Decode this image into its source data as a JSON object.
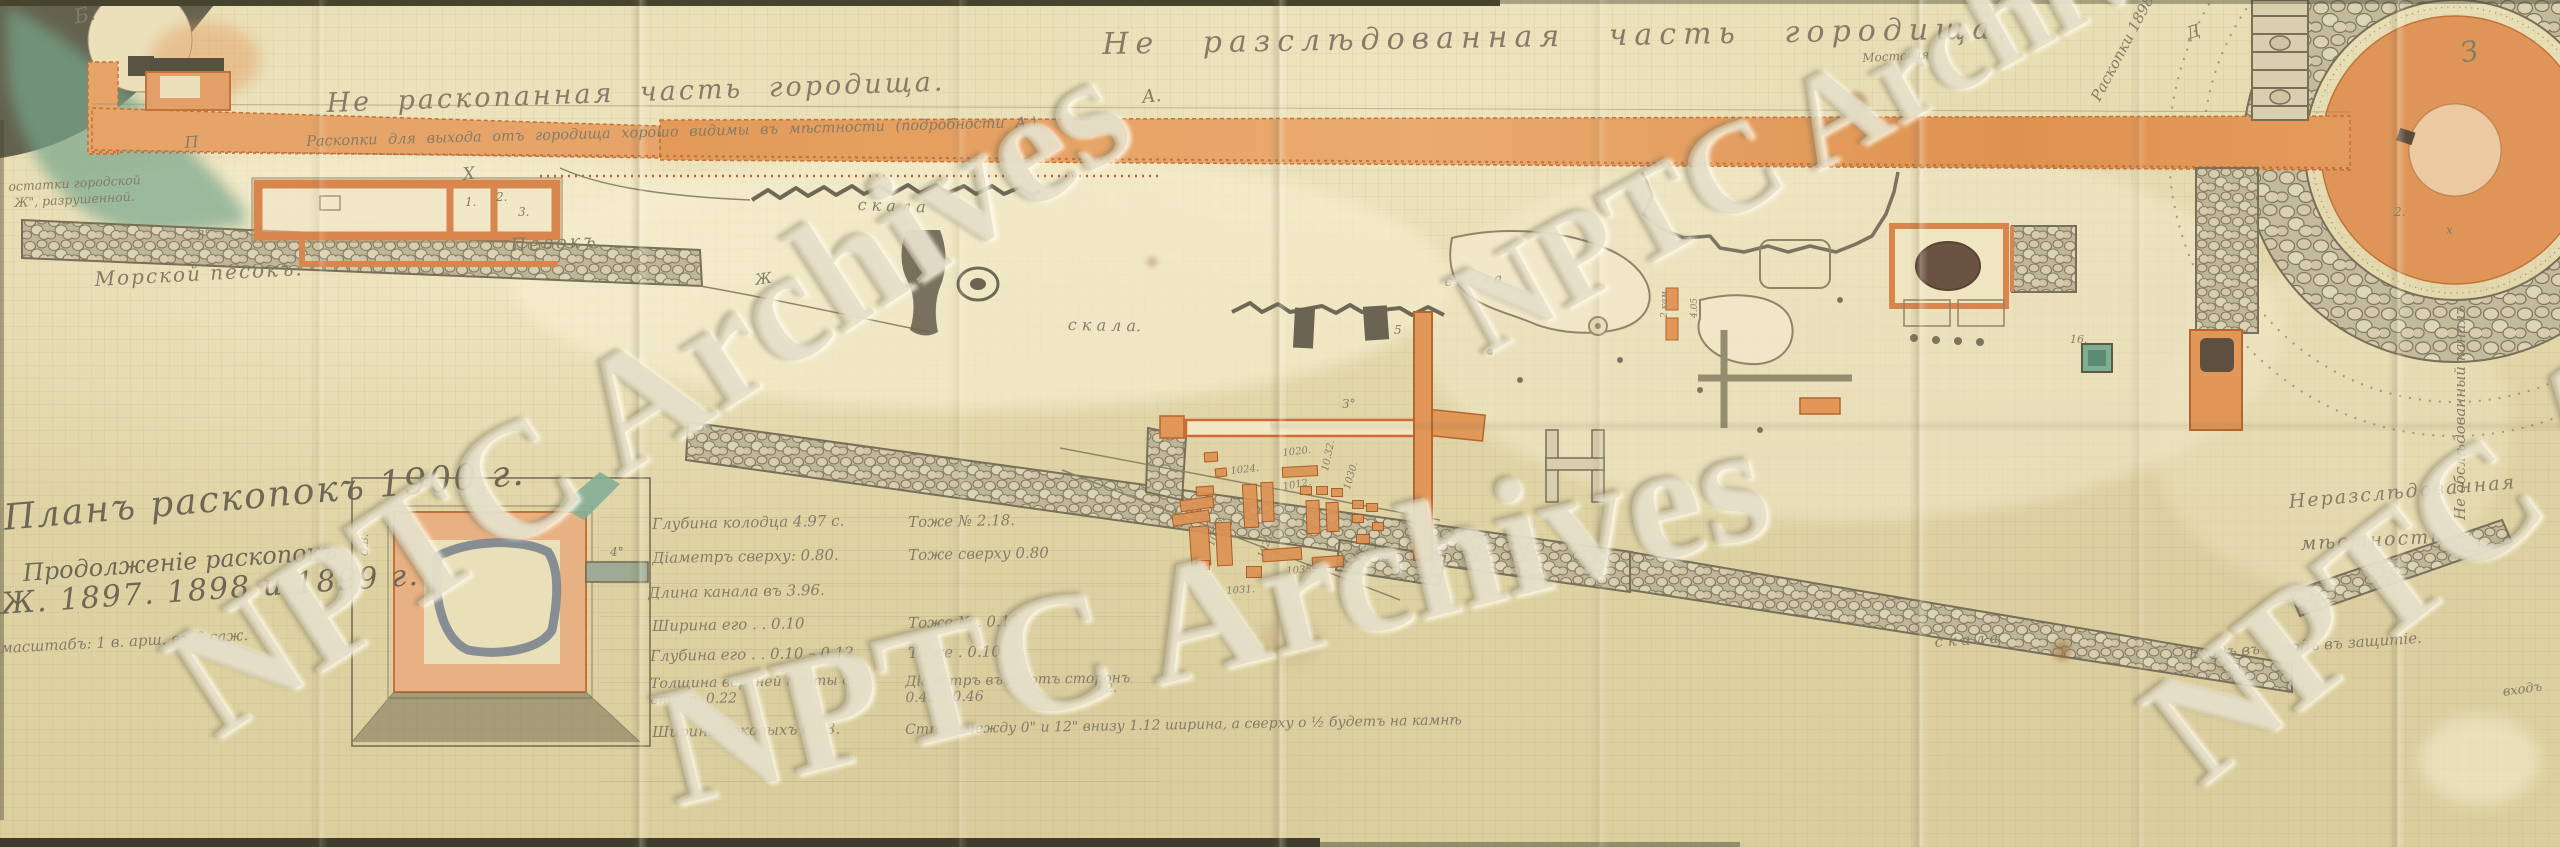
{
  "watermark": {
    "text": "NPTC Archives"
  },
  "titles": {
    "top_center": "Не разслѣдованная часть городища.",
    "top_left_1": "Не раскопанная часть городища.",
    "top_left_2": "Раскопки для выхода отъ городища хорошо видимы въ мѣстности (подробности А.)",
    "left_note_1": "остатки городской",
    "left_note_2": "Ж\", разрушенной."
  },
  "legend": {
    "line1": "Планъ раскопокъ 1900 г.",
    "line2": "Продолженіе раскопокъ",
    "line3": "Ж. 1897. 1898 и 1899 г.",
    "line4": "масштабъ: 1 в. арш. въ 6 саж."
  },
  "right_labels": {
    "area1": "Неразслѣдованная",
    "area2": "мѣстность.",
    "entrance": "Входъ въ городъ въ защитіе.",
    "entrance2": "входъ",
    "canal": "Не обслѣдованный каналъ",
    "raskopki": "Раскопки 1898 г."
  },
  "measurements": {
    "left": [
      "Глубина колодца 4.97 с.",
      "Діаметръ сверху: 0.80.",
      "Длина канала въ 3.96.",
      "Ширина его . . 0.10",
      "Глубина его . . 0.10 – 0.12",
      "Толщина верхней плиты со створ. 0.22",
      "Ширина боковыхъ 0.13."
    ],
    "right": [
      "Тоже № 2.18.",
      "Тоже сверху 0.80",
      "Тоже № . 0.13",
      "Тоже . 0.10",
      "Діаметръ въ №. отъ сторонъ 0.42 – 0.46",
      "Стѣна между 0\" и 12\" внизу 1.12 ширина, а сверху о ½ будетъ на камнѣ"
    ]
  },
  "labels": [
    {
      "t": "Б.",
      "x": 72,
      "y": 6,
      "s": 20,
      "r": -12
    },
    {
      "t": "П",
      "x": 184,
      "y": 134,
      "s": 16,
      "r": -4
    },
    {
      "t": "Х",
      "x": 462,
      "y": 166,
      "s": 17,
      "r": -6
    },
    {
      "t": "1.",
      "x": 465,
      "y": 196,
      "s": 12,
      "r": 0
    },
    {
      "t": "2.",
      "x": 496,
      "y": 191,
      "s": 12,
      "r": 0
    },
    {
      "t": "3.",
      "x": 518,
      "y": 206,
      "s": 12,
      "r": 0
    },
    {
      "t": "З°",
      "x": 196,
      "y": 230,
      "s": 13,
      "r": -5
    },
    {
      "t": "Ж",
      "x": 754,
      "y": 272,
      "s": 15,
      "r": -8
    },
    {
      "t": "Песокъ",
      "x": 510,
      "y": 236,
      "s": 18,
      "r": -3,
      "ls": 3
    },
    {
      "t": "Морской песокъ.",
      "x": 94,
      "y": 268,
      "s": 20,
      "r": -3,
      "ls": 2
    },
    {
      "t": "с к а л а",
      "x": 858,
      "y": 196,
      "s": 16,
      "r": 2
    },
    {
      "t": "с к а л а.",
      "x": 1068,
      "y": 316,
      "s": 16,
      "r": 1
    },
    {
      "t": "скала",
      "x": 1444,
      "y": 274,
      "s": 14,
      "r": -3,
      "ls": 4
    },
    {
      "t": "с к а л а",
      "x": 1934,
      "y": 634,
      "s": 15,
      "r": -4
    },
    {
      "t": "Мостовая",
      "x": 1862,
      "y": 52,
      "s": 12,
      "r": -3
    },
    {
      "t": "А.",
      "x": 1141,
      "y": 88,
      "s": 18,
      "r": -6
    },
    {
      "t": "5",
      "x": 1394,
      "y": 324,
      "s": 12,
      "r": 0
    },
    {
      "t": "З°",
      "x": 1342,
      "y": 398,
      "s": 12,
      "r": 0
    },
    {
      "t": "Д",
      "x": 2184,
      "y": 26,
      "s": 17,
      "r": -18
    },
    {
      "t": "З",
      "x": 2458,
      "y": 38,
      "s": 28,
      "r": -10
    },
    {
      "t": "2.",
      "x": 2394,
      "y": 206,
      "s": 12,
      "r": 0
    },
    {
      "t": "х",
      "x": 2446,
      "y": 224,
      "s": 12,
      "r": 0
    },
    {
      "t": "16.",
      "x": 2070,
      "y": 334,
      "s": 11,
      "r": 0
    },
    {
      "t": "α",
      "x": 476,
      "y": 482,
      "s": 15,
      "r": 0
    },
    {
      "t": "4°",
      "x": 610,
      "y": 546,
      "s": 12,
      "r": 0
    },
    {
      "t": "62.",
      "x": 1098,
      "y": 682,
      "s": 12,
      "r": 0
    },
    {
      "t": "О.В.",
      "x": 360,
      "y": 556,
      "s": 10,
      "r": -90
    },
    {
      "t": "2 кам.",
      "x": 1660,
      "y": 318,
      "s": 9,
      "r": -90
    },
    {
      "t": "4.05",
      "x": 1690,
      "y": 318,
      "s": 9,
      "r": -90
    },
    {
      "t": "1020.",
      "x": 1282,
      "y": 448,
      "s": 10,
      "r": -6
    },
    {
      "t": "1024.",
      "x": 1230,
      "y": 466,
      "s": 10,
      "r": -6
    },
    {
      "t": "1012.",
      "x": 1282,
      "y": 482,
      "s": 10,
      "r": -10
    },
    {
      "t": "10.32.",
      "x": 1320,
      "y": 470,
      "s": 10,
      "r": -78
    },
    {
      "t": "10.33.",
      "x": 1296,
      "y": 540,
      "s": 10,
      "r": -72
    },
    {
      "t": "1-37.",
      "x": 1172,
      "y": 508,
      "s": 10,
      "r": -4
    },
    {
      "t": "1021.",
      "x": 1256,
      "y": 556,
      "s": 10,
      "r": -68
    },
    {
      "t": "10.36.",
      "x": 1206,
      "y": 544,
      "s": 10,
      "r": -70
    },
    {
      "t": "1035.",
      "x": 1286,
      "y": 566,
      "s": 10,
      "r": -4
    },
    {
      "t": "1030.",
      "x": 1342,
      "y": 488,
      "s": 10,
      "r": -74
    },
    {
      "t": "1031.",
      "x": 1226,
      "y": 586,
      "s": 10,
      "r": -4
    },
    {
      "t": "10-38.",
      "x": 1352,
      "y": 560,
      "s": 10,
      "r": -70
    }
  ],
  "find_rects": [
    {
      "x": 1204,
      "y": 452,
      "w": 14,
      "h": 10,
      "r": -4
    },
    {
      "x": 1215,
      "y": 468,
      "w": 12,
      "h": 9,
      "r": -6
    },
    {
      "x": 1196,
      "y": 486,
      "w": 18,
      "h": 10,
      "r": -4
    },
    {
      "x": 1243,
      "y": 484,
      "w": 15,
      "h": 44,
      "r": -3
    },
    {
      "x": 1261,
      "y": 482,
      "w": 13,
      "h": 40,
      "r": -2
    },
    {
      "x": 1282,
      "y": 466,
      "w": 36,
      "h": 11,
      "r": -3
    },
    {
      "x": 1300,
      "y": 486,
      "w": 12,
      "h": 9,
      "r": 0
    },
    {
      "x": 1316,
      "y": 486,
      "w": 12,
      "h": 9,
      "r": 0
    },
    {
      "x": 1331,
      "y": 488,
      "w": 12,
      "h": 9,
      "r": 0
    },
    {
      "x": 1306,
      "y": 500,
      "w": 14,
      "h": 34,
      "r": -2
    },
    {
      "x": 1326,
      "y": 502,
      "w": 13,
      "h": 30,
      "r": -2
    },
    {
      "x": 1352,
      "y": 500,
      "w": 12,
      "h": 9,
      "r": 0
    },
    {
      "x": 1366,
      "y": 503,
      "w": 12,
      "h": 9,
      "r": 0
    },
    {
      "x": 1352,
      "y": 514,
      "w": 12,
      "h": 9,
      "r": 0
    },
    {
      "x": 1180,
      "y": 498,
      "w": 34,
      "h": 12,
      "r": -8
    },
    {
      "x": 1172,
      "y": 512,
      "w": 38,
      "h": 12,
      "r": -8
    },
    {
      "x": 1190,
      "y": 526,
      "w": 20,
      "h": 40,
      "r": -4
    },
    {
      "x": 1216,
      "y": 522,
      "w": 16,
      "h": 44,
      "r": -3
    },
    {
      "x": 1262,
      "y": 548,
      "w": 40,
      "h": 13,
      "r": -4
    },
    {
      "x": 1312,
      "y": 556,
      "w": 32,
      "h": 12,
      "r": -4
    },
    {
      "x": 1246,
      "y": 566,
      "w": 16,
      "h": 12,
      "r": 0
    },
    {
      "x": 1196,
      "y": 560,
      "w": 14,
      "h": 10,
      "r": 0
    },
    {
      "x": 1356,
      "y": 534,
      "w": 14,
      "h": 10,
      "r": 0
    },
    {
      "x": 1372,
      "y": 522,
      "w": 12,
      "h": 9,
      "r": 0
    }
  ],
  "watermarks": [
    {
      "x": 140,
      "y": 790,
      "r": -33,
      "s": 165
    },
    {
      "x": 640,
      "y": 838,
      "r": -14,
      "s": 170
    },
    {
      "x": 1430,
      "y": 392,
      "r": -29,
      "s": 130
    },
    {
      "x": 2115,
      "y": 845,
      "r": -38,
      "s": 165
    }
  ]
}
